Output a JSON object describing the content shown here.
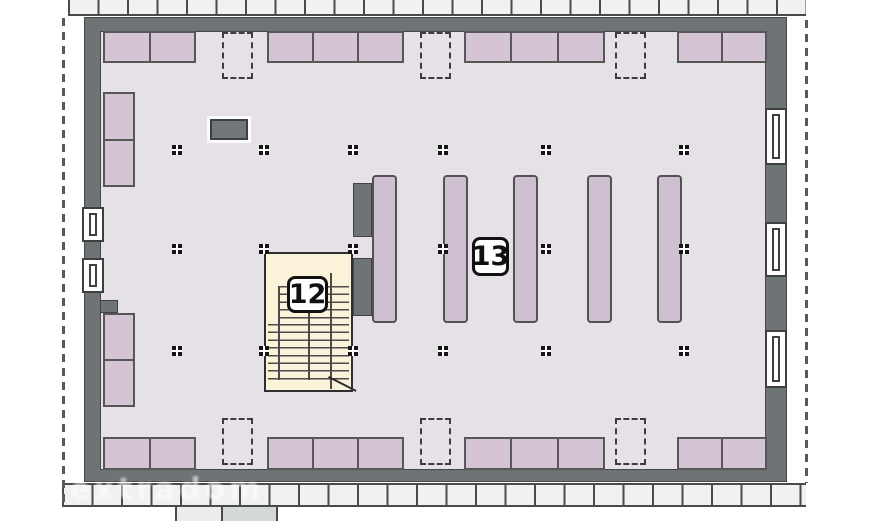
{
  "watermark": "extradom",
  "rooms": [
    {
      "label": "12",
      "x": 287,
      "y": 276,
      "width": 41,
      "height": 37
    },
    {
      "label": "13",
      "x": 472,
      "y": 237,
      "width": 37,
      "height": 39
    }
  ],
  "colors": {
    "wall_gray": "#6e7375",
    "floor_lavender": "#e6e0e7",
    "cabinet_purple": "#d4c4d4",
    "beam_purple": "#cfc0d1",
    "stair_cream": "#faf3d9",
    "roof_tile_gray": "#f0f1f1",
    "line_dark": "#4a4a4a"
  },
  "plan": {
    "chimney": {
      "x": 210,
      "y": 119,
      "width": 38,
      "height": 21
    },
    "stair_side_walls": [
      {
        "x": 353,
        "y": 183,
        "width": 19,
        "height": 54
      },
      {
        "x": 353,
        "y": 258,
        "width": 19,
        "height": 58
      }
    ],
    "wall_notches": [
      {
        "x": 100,
        "y": 300,
        "width": 18,
        "height": 13
      },
      {
        "x": 103,
        "y": 395,
        "width": 10,
        "height": 12
      }
    ],
    "beams": {
      "x": [
        372,
        443,
        513,
        587,
        657
      ],
      "y": 175,
      "width": 25,
      "height": 148
    },
    "skylights": {
      "x": [
        222,
        420,
        615
      ],
      "width": 31,
      "height": 47,
      "top_row_y": 32,
      "bottom_row_y": 418
    },
    "wall_cabinets_top": {
      "y": 31,
      "height": 32,
      "groups": [
        {
          "x": 103,
          "width": 93,
          "cells": 2
        },
        {
          "x": 267,
          "width": 137,
          "cells": 3
        },
        {
          "x": 464,
          "width": 141,
          "cells": 3
        },
        {
          "x": 677,
          "width": 90,
          "cells": 2
        }
      ]
    },
    "wall_cabinets_bottom": {
      "y": 437,
      "height": 33,
      "groups": [
        {
          "x": 103,
          "width": 93,
          "cells": 2
        },
        {
          "x": 267,
          "width": 137,
          "cells": 3
        },
        {
          "x": 464,
          "width": 141,
          "cells": 3
        },
        {
          "x": 677,
          "width": 90,
          "cells": 2
        }
      ]
    },
    "wall_cabinets_left": {
      "x": 103,
      "width": 32,
      "groups": [
        {
          "y": 92,
          "height": 95,
          "cells": 2
        },
        {
          "y": 313,
          "height": 94,
          "cells": 2
        }
      ]
    },
    "windows": {
      "left": {
        "x": 82,
        "width": 22,
        "items": [
          {
            "y": 207,
            "height": 35
          },
          {
            "y": 258,
            "height": 35
          }
        ]
      },
      "right": {
        "x": 765,
        "width": 22,
        "items": [
          {
            "y": 108,
            "height": 57
          },
          {
            "y": 222,
            "height": 55
          },
          {
            "y": 330,
            "height": 58
          }
        ]
      }
    },
    "columns": {
      "size": 10,
      "rows_y": [
        150,
        249,
        351
      ],
      "cols_x": [
        177,
        264,
        353,
        443,
        546,
        684
      ]
    }
  }
}
